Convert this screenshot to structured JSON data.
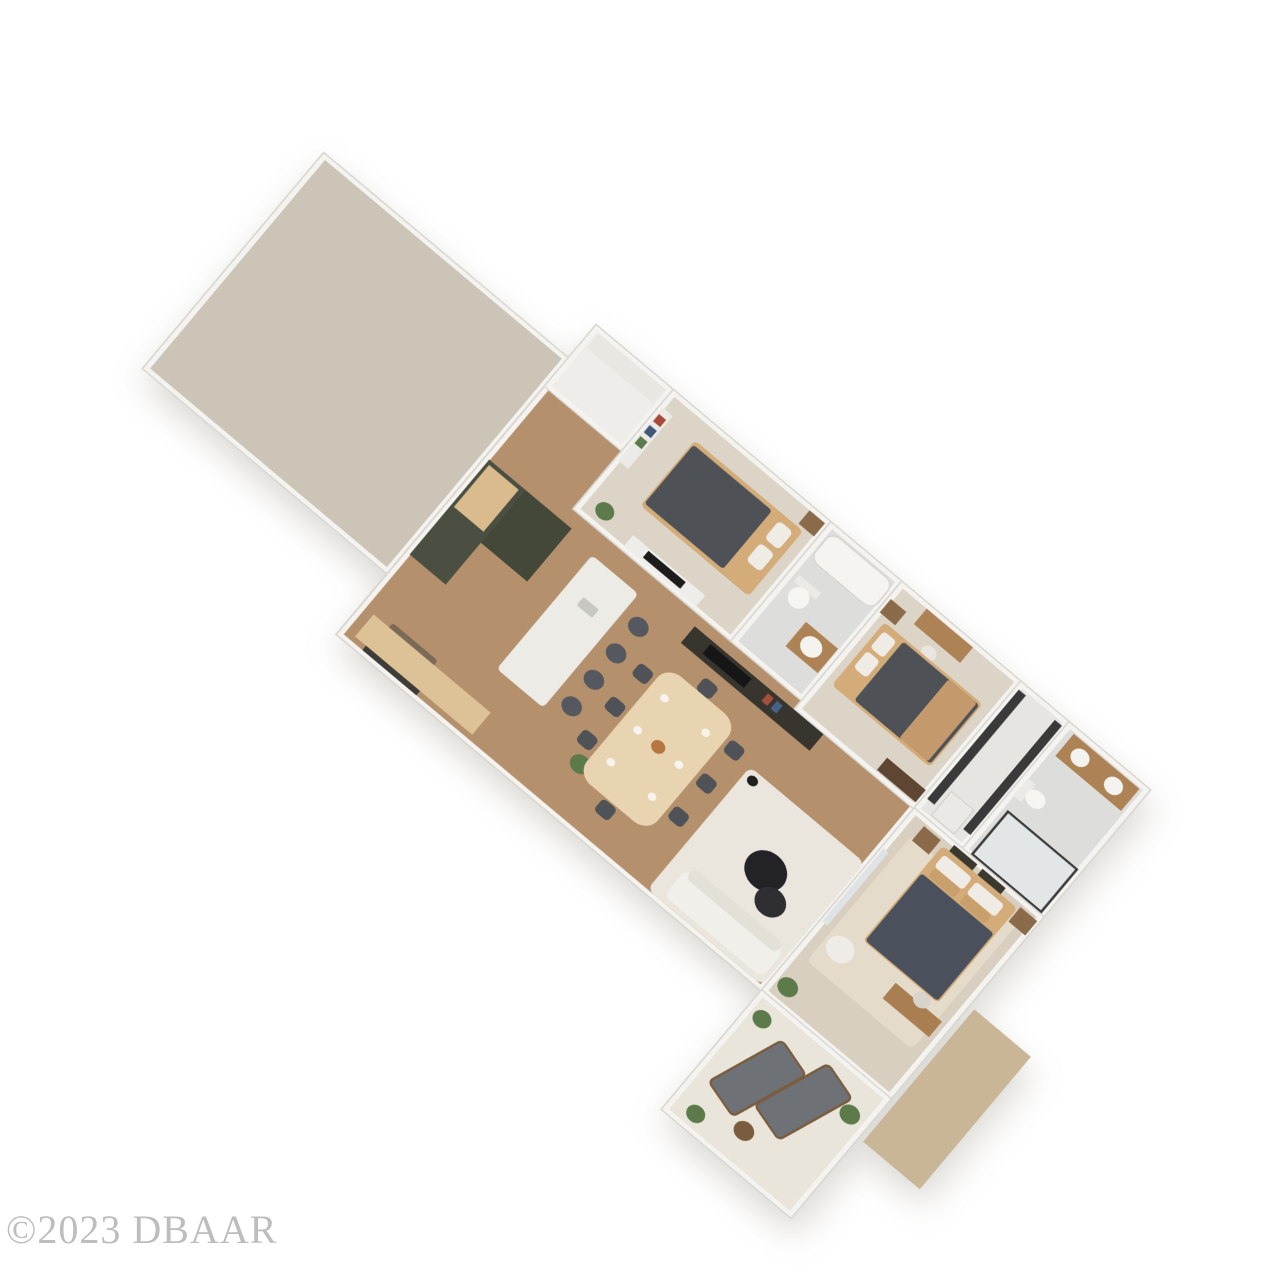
{
  "meta": {
    "scene": "3D rendered residential floor plan, angled top-down view on white background",
    "background": "#ffffff",
    "watermark": "©2023 DBAAR",
    "watermark_color": "#b2b2b2"
  },
  "palette": {
    "wall": "#f4f3f0",
    "wall_edge": "#d9d7d2",
    "wood_floor": "#b4916c",
    "garage_floor": "#cbc4b7",
    "carpet": "#dcd4c6",
    "tile": "#dddddb",
    "patio_floor": "#e9e5da",
    "cabinet_green": "#4a4f42",
    "bed_wood": "#d3ac79",
    "comforter_dark": "#4e5257",
    "plant_green": "#5d7a4a",
    "outdoor_gray": "#6e7276"
  },
  "plan": {
    "width": 1340,
    "height": 790,
    "rotation_deg": 40,
    "scale_x": 0.84,
    "scale_y": 0.72,
    "rooms": [
      {
        "name": "garage",
        "x": 0,
        "y": 60,
        "w": 380,
        "h": 390,
        "floor": "#cbc4b7"
      },
      {
        "name": "main-living-area",
        "x": 380,
        "y": 0,
        "w": 660,
        "h": 560,
        "floor": "#b4916c"
      },
      {
        "name": "entry-closet",
        "x": 380,
        "y": 0,
        "w": 120,
        "h": 110,
        "floor": "#efede9"
      },
      {
        "name": "bedroom-1",
        "x": 500,
        "y": 0,
        "w": 245,
        "h": 215,
        "floor": "#dcd4c6"
      },
      {
        "name": "bathroom-1",
        "x": 745,
        "y": 0,
        "w": 110,
        "h": 215,
        "floor": "#dddddb"
      },
      {
        "name": "bedroom-2",
        "x": 855,
        "y": 0,
        "w": 185,
        "h": 230,
        "floor": "#dcd4c6"
      },
      {
        "name": "laundry-closet",
        "x": 1040,
        "y": 0,
        "w": 75,
        "h": 230,
        "floor": "#e7e5e1"
      },
      {
        "name": "master-bathroom",
        "x": 1115,
        "y": 0,
        "w": 125,
        "h": 230,
        "floor": "#dddddb"
      },
      {
        "name": "master-bedroom",
        "x": 1040,
        "y": 230,
        "w": 200,
        "h": 330,
        "floor": "#d8cfc0"
      },
      {
        "name": "patio-lanai",
        "x": 1040,
        "y": 560,
        "w": 200,
        "h": 215,
        "floor": "#e9e5da"
      },
      {
        "name": "backyard-ground",
        "x": 1248,
        "y": 390,
        "w": 88,
        "h": 240,
        "floor": "#c9b697",
        "walls": false
      }
    ],
    "furniture": [
      {
        "name": "front-door",
        "x": 415,
        "y": 538,
        "w": 84,
        "h": 16,
        "c": "#3e3c39"
      },
      {
        "name": "door-mat",
        "x": 422,
        "y": 498,
        "w": 70,
        "h": 36,
        "c": "#7b6a55",
        "r": 4
      },
      {
        "name": "entry-shelf",
        "x": 388,
        "y": 6,
        "w": 104,
        "h": 26,
        "c": "#e9e7e2"
      },
      {
        "name": "bookshelf",
        "x": 503,
        "y": 28,
        "w": 16,
        "h": 96,
        "c": "#eceae6"
      },
      {
        "name": "book-red",
        "x": 505,
        "y": 38,
        "w": 11,
        "h": 13,
        "c": "#a84a38"
      },
      {
        "name": "book-blue",
        "x": 505,
        "y": 58,
        "w": 11,
        "h": 13,
        "c": "#3f5a78"
      },
      {
        "name": "book-green",
        "x": 505,
        "y": 78,
        "w": 11,
        "h": 13,
        "c": "#5d7a4a"
      },
      {
        "name": "kitchen-cabinets",
        "x": 385,
        "y": 238,
        "w": 56,
        "h": 172,
        "c": "#4a4f42"
      },
      {
        "name": "kitchen-countertop",
        "x": 389,
        "y": 244,
        "w": 46,
        "h": 76,
        "c": "#d9bb8e"
      },
      {
        "name": "kitchen-tall-cabinet",
        "x": 441,
        "y": 238,
        "w": 72,
        "h": 96,
        "c": "#434839"
      },
      {
        "name": "island-base",
        "x": 560,
        "y": 256,
        "w": 60,
        "h": 192,
        "c": "#3f4437"
      },
      {
        "name": "island-countertop",
        "x": 552,
        "y": 248,
        "w": 72,
        "h": 206,
        "c": "#edebe6",
        "r": 6
      },
      {
        "name": "island-sink",
        "x": 576,
        "y": 300,
        "w": 24,
        "h": 15,
        "c": "#c7c7c4",
        "r": 3
      },
      {
        "name": "bar-stool-1",
        "x": 636,
        "y": 270,
        "w": 26,
        "h": 26,
        "c": "#55585e",
        "r": "50%"
      },
      {
        "name": "bar-stool-2",
        "x": 636,
        "y": 318,
        "w": 26,
        "h": 26,
        "c": "#55585e",
        "r": "50%"
      },
      {
        "name": "bar-stool-3",
        "x": 636,
        "y": 366,
        "w": 26,
        "h": 26,
        "c": "#55585e",
        "r": "50%"
      },
      {
        "name": "bar-stool-4",
        "x": 636,
        "y": 414,
        "w": 26,
        "h": 26,
        "c": "#55585e",
        "r": "50%"
      },
      {
        "name": "sideboard-bench",
        "x": 398,
        "y": 506,
        "w": 182,
        "h": 40,
        "c": "#ddc197"
      },
      {
        "name": "kitchen-plant",
        "x": 688,
        "y": 468,
        "w": 26,
        "h": 26,
        "c": "#5d7a4a",
        "r": "50%"
      },
      {
        "name": "dining-table",
        "x": 705,
        "y": 298,
        "w": 110,
        "h": 196,
        "c": "#e8d4b0",
        "r": 22
      },
      {
        "name": "dining-chair-1",
        "x": 678,
        "y": 318,
        "w": 22,
        "h": 22,
        "c": "#4f5358",
        "r": 6
      },
      {
        "name": "dining-chair-2",
        "x": 678,
        "y": 378,
        "w": 22,
        "h": 22,
        "c": "#4f5358",
        "r": 6
      },
      {
        "name": "dining-chair-3",
        "x": 678,
        "y": 438,
        "w": 22,
        "h": 22,
        "c": "#4f5358",
        "r": 6
      },
      {
        "name": "dining-chair-4",
        "x": 820,
        "y": 318,
        "w": 22,
        "h": 22,
        "c": "#4f5358",
        "r": 6
      },
      {
        "name": "dining-chair-5",
        "x": 820,
        "y": 378,
        "w": 22,
        "h": 22,
        "c": "#4f5358",
        "r": 6
      },
      {
        "name": "dining-chair-6",
        "x": 820,
        "y": 438,
        "w": 22,
        "h": 22,
        "c": "#4f5358",
        "r": 6
      },
      {
        "name": "dining-chair-7",
        "x": 748,
        "y": 276,
        "w": 22,
        "h": 22,
        "c": "#4f5358",
        "r": 6
      },
      {
        "name": "dining-chair-8",
        "x": 748,
        "y": 496,
        "w": 22,
        "h": 22,
        "c": "#4f5358",
        "r": 6
      },
      {
        "name": "place-setting-1",
        "x": 722,
        "y": 330,
        "w": 11,
        "h": 11,
        "c": "#f6f4ef",
        "r": "50%"
      },
      {
        "name": "place-setting-2",
        "x": 722,
        "y": 388,
        "w": 11,
        "h": 11,
        "c": "#f6f4ef",
        "r": "50%"
      },
      {
        "name": "place-setting-3",
        "x": 722,
        "y": 446,
        "w": 11,
        "h": 11,
        "c": "#f6f4ef",
        "r": "50%"
      },
      {
        "name": "place-setting-4",
        "x": 786,
        "y": 330,
        "w": 11,
        "h": 11,
        "c": "#f6f4ef",
        "r": "50%"
      },
      {
        "name": "place-setting-5",
        "x": 786,
        "y": 388,
        "w": 11,
        "h": 11,
        "c": "#f6f4ef",
        "r": "50%"
      },
      {
        "name": "place-setting-6",
        "x": 786,
        "y": 446,
        "w": 11,
        "h": 11,
        "c": "#f6f4ef",
        "r": "50%"
      },
      {
        "name": "centerpiece",
        "x": 750,
        "y": 384,
        "w": 18,
        "h": 18,
        "c": "#b5763f",
        "r": "50%"
      },
      {
        "name": "media-wall",
        "x": 700,
        "y": 232,
        "w": 200,
        "h": 30,
        "c": "#38352f"
      },
      {
        "name": "tv-screen",
        "x": 728,
        "y": 237,
        "w": 64,
        "h": 17,
        "c": "#161616"
      },
      {
        "name": "decor-red",
        "x": 818,
        "y": 238,
        "w": 9,
        "h": 14,
        "c": "#a5503c"
      },
      {
        "name": "decor-blue",
        "x": 832,
        "y": 238,
        "w": 9,
        "h": 14,
        "c": "#46628a"
      },
      {
        "name": "area-rug",
        "x": 858,
        "y": 332,
        "w": 178,
        "h": 222,
        "c": "#eae6dd",
        "r": 10
      },
      {
        "name": "sofa",
        "x": 878,
        "y": 498,
        "w": 152,
        "h": 48,
        "c": "#f1efe9",
        "r": 10
      },
      {
        "name": "sofa-cushions",
        "x": 884,
        "y": 490,
        "w": 140,
        "h": 18,
        "c": "#e3e0d8",
        "r": 8
      },
      {
        "name": "coffee-table-large",
        "x": 925,
        "y": 402,
        "w": 54,
        "h": 54,
        "c": "#232327",
        "r": "50%"
      },
      {
        "name": "coffee-table-small",
        "x": 960,
        "y": 438,
        "w": 40,
        "h": 40,
        "c": "#2e2e33",
        "r": "50%"
      },
      {
        "name": "floor-lamp",
        "x": 864,
        "y": 338,
        "w": 14,
        "h": 14,
        "c": "#1f1f1f",
        "r": "50%"
      },
      {
        "name": "bathtub",
        "x": 752,
        "y": 8,
        "w": 94,
        "h": 46,
        "c": "#f5f4f1",
        "r": 14,
        "b": "2px solid #d8d6d1"
      },
      {
        "name": "toilet-tank",
        "x": 756,
        "y": 84,
        "w": 34,
        "h": 12,
        "c": "#eceae6"
      },
      {
        "name": "toilet-bowl",
        "x": 760,
        "y": 94,
        "w": 26,
        "h": 30,
        "c": "#f6f5f2",
        "r": "50%"
      },
      {
        "name": "bath-vanity",
        "x": 798,
        "y": 128,
        "w": 50,
        "h": 44,
        "c": "#ad8355"
      },
      {
        "name": "bath-sink",
        "x": 808,
        "y": 136,
        "w": 28,
        "h": 28,
        "c": "#f4f3f0",
        "r": "50%"
      },
      {
        "name": "bed1-frame",
        "x": 558,
        "y": 34,
        "w": 168,
        "h": 118,
        "c": "#d3ac79",
        "r": 6
      },
      {
        "name": "bed1-comforter",
        "x": 560,
        "y": 40,
        "w": 122,
        "h": 106,
        "c": "#4e5257",
        "r": 4
      },
      {
        "name": "bed1-pillow-1",
        "x": 696,
        "y": 44,
        "w": 22,
        "h": 32,
        "c": "#efece6",
        "r": 6
      },
      {
        "name": "bed1-pillow-2",
        "x": 696,
        "y": 84,
        "w": 22,
        "h": 32,
        "c": "#efece6",
        "r": 6
      },
      {
        "name": "nightstand-1",
        "x": 716,
        "y": 6,
        "w": 24,
        "h": 24,
        "c": "#8a6a48"
      },
      {
        "name": "bedroom1-plant",
        "x": 518,
        "y": 178,
        "w": 24,
        "h": 24,
        "c": "#5d7a4a",
        "r": "50%"
      },
      {
        "name": "tv-console-1",
        "x": 574,
        "y": 190,
        "w": 112,
        "h": 20,
        "c": "#efede9"
      },
      {
        "name": "tv-1",
        "x": 600,
        "y": 193,
        "w": 58,
        "h": 12,
        "c": "#1c1c1c"
      },
      {
        "name": "vanity-desk",
        "x": 898,
        "y": 6,
        "w": 72,
        "h": 28,
        "c": "#ad8355"
      },
      {
        "name": "vanity-stool",
        "x": 924,
        "y": 42,
        "w": 20,
        "h": 20,
        "c": "#e9e6e0",
        "r": "50%"
      },
      {
        "name": "nightstand-2",
        "x": 858,
        "y": 28,
        "w": 24,
        "h": 24,
        "c": "#8a6a48"
      },
      {
        "name": "bed2-frame",
        "x": 870,
        "y": 58,
        "w": 152,
        "h": 114,
        "c": "#d3ac79",
        "r": 6
      },
      {
        "name": "bed2-pillow-1",
        "x": 876,
        "y": 68,
        "w": 20,
        "h": 30,
        "c": "#efece6",
        "r": 5
      },
      {
        "name": "bed2-pillow-2",
        "x": 876,
        "y": 104,
        "w": 20,
        "h": 30,
        "c": "#efece6",
        "r": 5
      },
      {
        "name": "bed2-comforter",
        "x": 902,
        "y": 62,
        "w": 118,
        "h": 106,
        "c": "#4e5257",
        "r": 4
      },
      {
        "name": "bed2-throw",
        "x": 972,
        "y": 62,
        "w": 44,
        "h": 106,
        "c": "#c49a6c",
        "r": 3
      },
      {
        "name": "bedroom2-dresser",
        "x": 976,
        "y": 200,
        "w": 60,
        "h": 22,
        "c": "#5f4632"
      },
      {
        "name": "wire-shelf-1",
        "x": 1044,
        "y": 10,
        "w": 11,
        "h": 198,
        "c": "#3a3a3a"
      },
      {
        "name": "wire-shelf-2",
        "x": 1100,
        "y": 10,
        "w": 11,
        "h": 198,
        "c": "#3a3a3a"
      },
      {
        "name": "washer",
        "x": 1060,
        "y": 178,
        "w": 34,
        "h": 42,
        "c": "#ebe9e5",
        "b": "1px solid #c9c7c2"
      },
      {
        "name": "master-vanity",
        "x": 1128,
        "y": 8,
        "w": 102,
        "h": 40,
        "c": "#ad8355"
      },
      {
        "name": "master-sink-1",
        "x": 1140,
        "y": 16,
        "w": 24,
        "h": 24,
        "c": "#f4f3f0",
        "r": "50%"
      },
      {
        "name": "master-sink-2",
        "x": 1192,
        "y": 16,
        "w": 24,
        "h": 24,
        "c": "#f4f3f0",
        "r": "50%"
      },
      {
        "name": "master-toilet-tank",
        "x": 1120,
        "y": 96,
        "w": 12,
        "h": 32,
        "c": "#eceae6"
      },
      {
        "name": "master-toilet-bowl",
        "x": 1130,
        "y": 100,
        "w": 26,
        "h": 24,
        "c": "#f6f5f2",
        "r": "50%"
      },
      {
        "name": "shower",
        "x": 1126,
        "y": 148,
        "w": 104,
        "h": 74,
        "c": "#e3e6e7",
        "b": "3px solid #3c3c3c"
      },
      {
        "name": "master-rug",
        "x": 1058,
        "y": 262,
        "w": 164,
        "h": 226,
        "c": "#e4dbcb",
        "r": 8
      },
      {
        "name": "art-frame-1",
        "x": 1104,
        "y": 233,
        "w": 36,
        "h": 15,
        "c": "#3b382f"
      },
      {
        "name": "art-frame-2",
        "x": 1148,
        "y": 233,
        "w": 36,
        "h": 15,
        "c": "#3b382f"
      },
      {
        "name": "nightstand-m1",
        "x": 1062,
        "y": 240,
        "w": 26,
        "h": 26,
        "c": "#8a6a48"
      },
      {
        "name": "nightstand-m2",
        "x": 1212,
        "y": 240,
        "w": 26,
        "h": 26,
        "c": "#8a6a48"
      },
      {
        "name": "master-bed-frame",
        "x": 1094,
        "y": 244,
        "w": 116,
        "h": 172,
        "c": "#d3ac79",
        "r": 6
      },
      {
        "name": "master-pillow-1",
        "x": 1102,
        "y": 252,
        "w": 44,
        "h": 22,
        "c": "#efece6",
        "r": 5
      },
      {
        "name": "master-pillow-2",
        "x": 1152,
        "y": 252,
        "w": 44,
        "h": 22,
        "c": "#efece6",
        "r": 5
      },
      {
        "name": "master-pillow-3",
        "x": 1104,
        "y": 274,
        "w": 40,
        "h": 16,
        "c": "#c9a06b",
        "r": 4
      },
      {
        "name": "master-pillow-4",
        "x": 1152,
        "y": 274,
        "w": 40,
        "h": 16,
        "c": "#c9a06b",
        "r": 4
      },
      {
        "name": "master-comforter",
        "x": 1096,
        "y": 292,
        "w": 112,
        "h": 122,
        "c": "#4a505c",
        "r": 4
      },
      {
        "name": "master-pouf",
        "x": 1062,
        "y": 428,
        "w": 36,
        "h": 36,
        "c": "#efece7",
        "r": "50%"
      },
      {
        "name": "master-dresser",
        "x": 1156,
        "y": 432,
        "w": 72,
        "h": 28,
        "c": "#a97f52"
      },
      {
        "name": "master-mirror",
        "x": 1182,
        "y": 416,
        "w": 22,
        "h": 22,
        "c": "#d8d4cc",
        "r": "50%"
      },
      {
        "name": "sliding-door",
        "x": 1042,
        "y": 300,
        "w": 8,
        "h": 132,
        "c": "#dfe3e5"
      },
      {
        "name": "master-plant",
        "x": 1048,
        "y": 520,
        "w": 26,
        "h": 26,
        "c": "#5d7a4a",
        "r": "50%"
      },
      {
        "name": "lounger-1",
        "x": 1076,
        "y": 598,
        "w": 48,
        "h": 112,
        "c": "#6e7276",
        "r": 8,
        "rot": 18,
        "b": "3px solid #7a5c3e"
      },
      {
        "name": "lounger-2",
        "x": 1136,
        "y": 582,
        "w": 48,
        "h": 112,
        "c": "#6e7276",
        "r": 8,
        "rot": 18,
        "b": "3px solid #7a5c3e"
      },
      {
        "name": "patio-side-table",
        "x": 1118,
        "y": 712,
        "w": 26,
        "h": 26,
        "c": "#7a5c3e",
        "r": "50%"
      },
      {
        "name": "patio-plant-1",
        "x": 1050,
        "y": 578,
        "w": 24,
        "h": 24,
        "c": "#5d7a4a",
        "r": "50%"
      },
      {
        "name": "patio-plant-2",
        "x": 1202,
        "y": 600,
        "w": 26,
        "h": 26,
        "c": "#5d7a4a",
        "r": "50%"
      },
      {
        "name": "patio-plant-3",
        "x": 1062,
        "y": 738,
        "w": 24,
        "h": 24,
        "c": "#5d7a4a",
        "r": "50%"
      }
    ]
  }
}
